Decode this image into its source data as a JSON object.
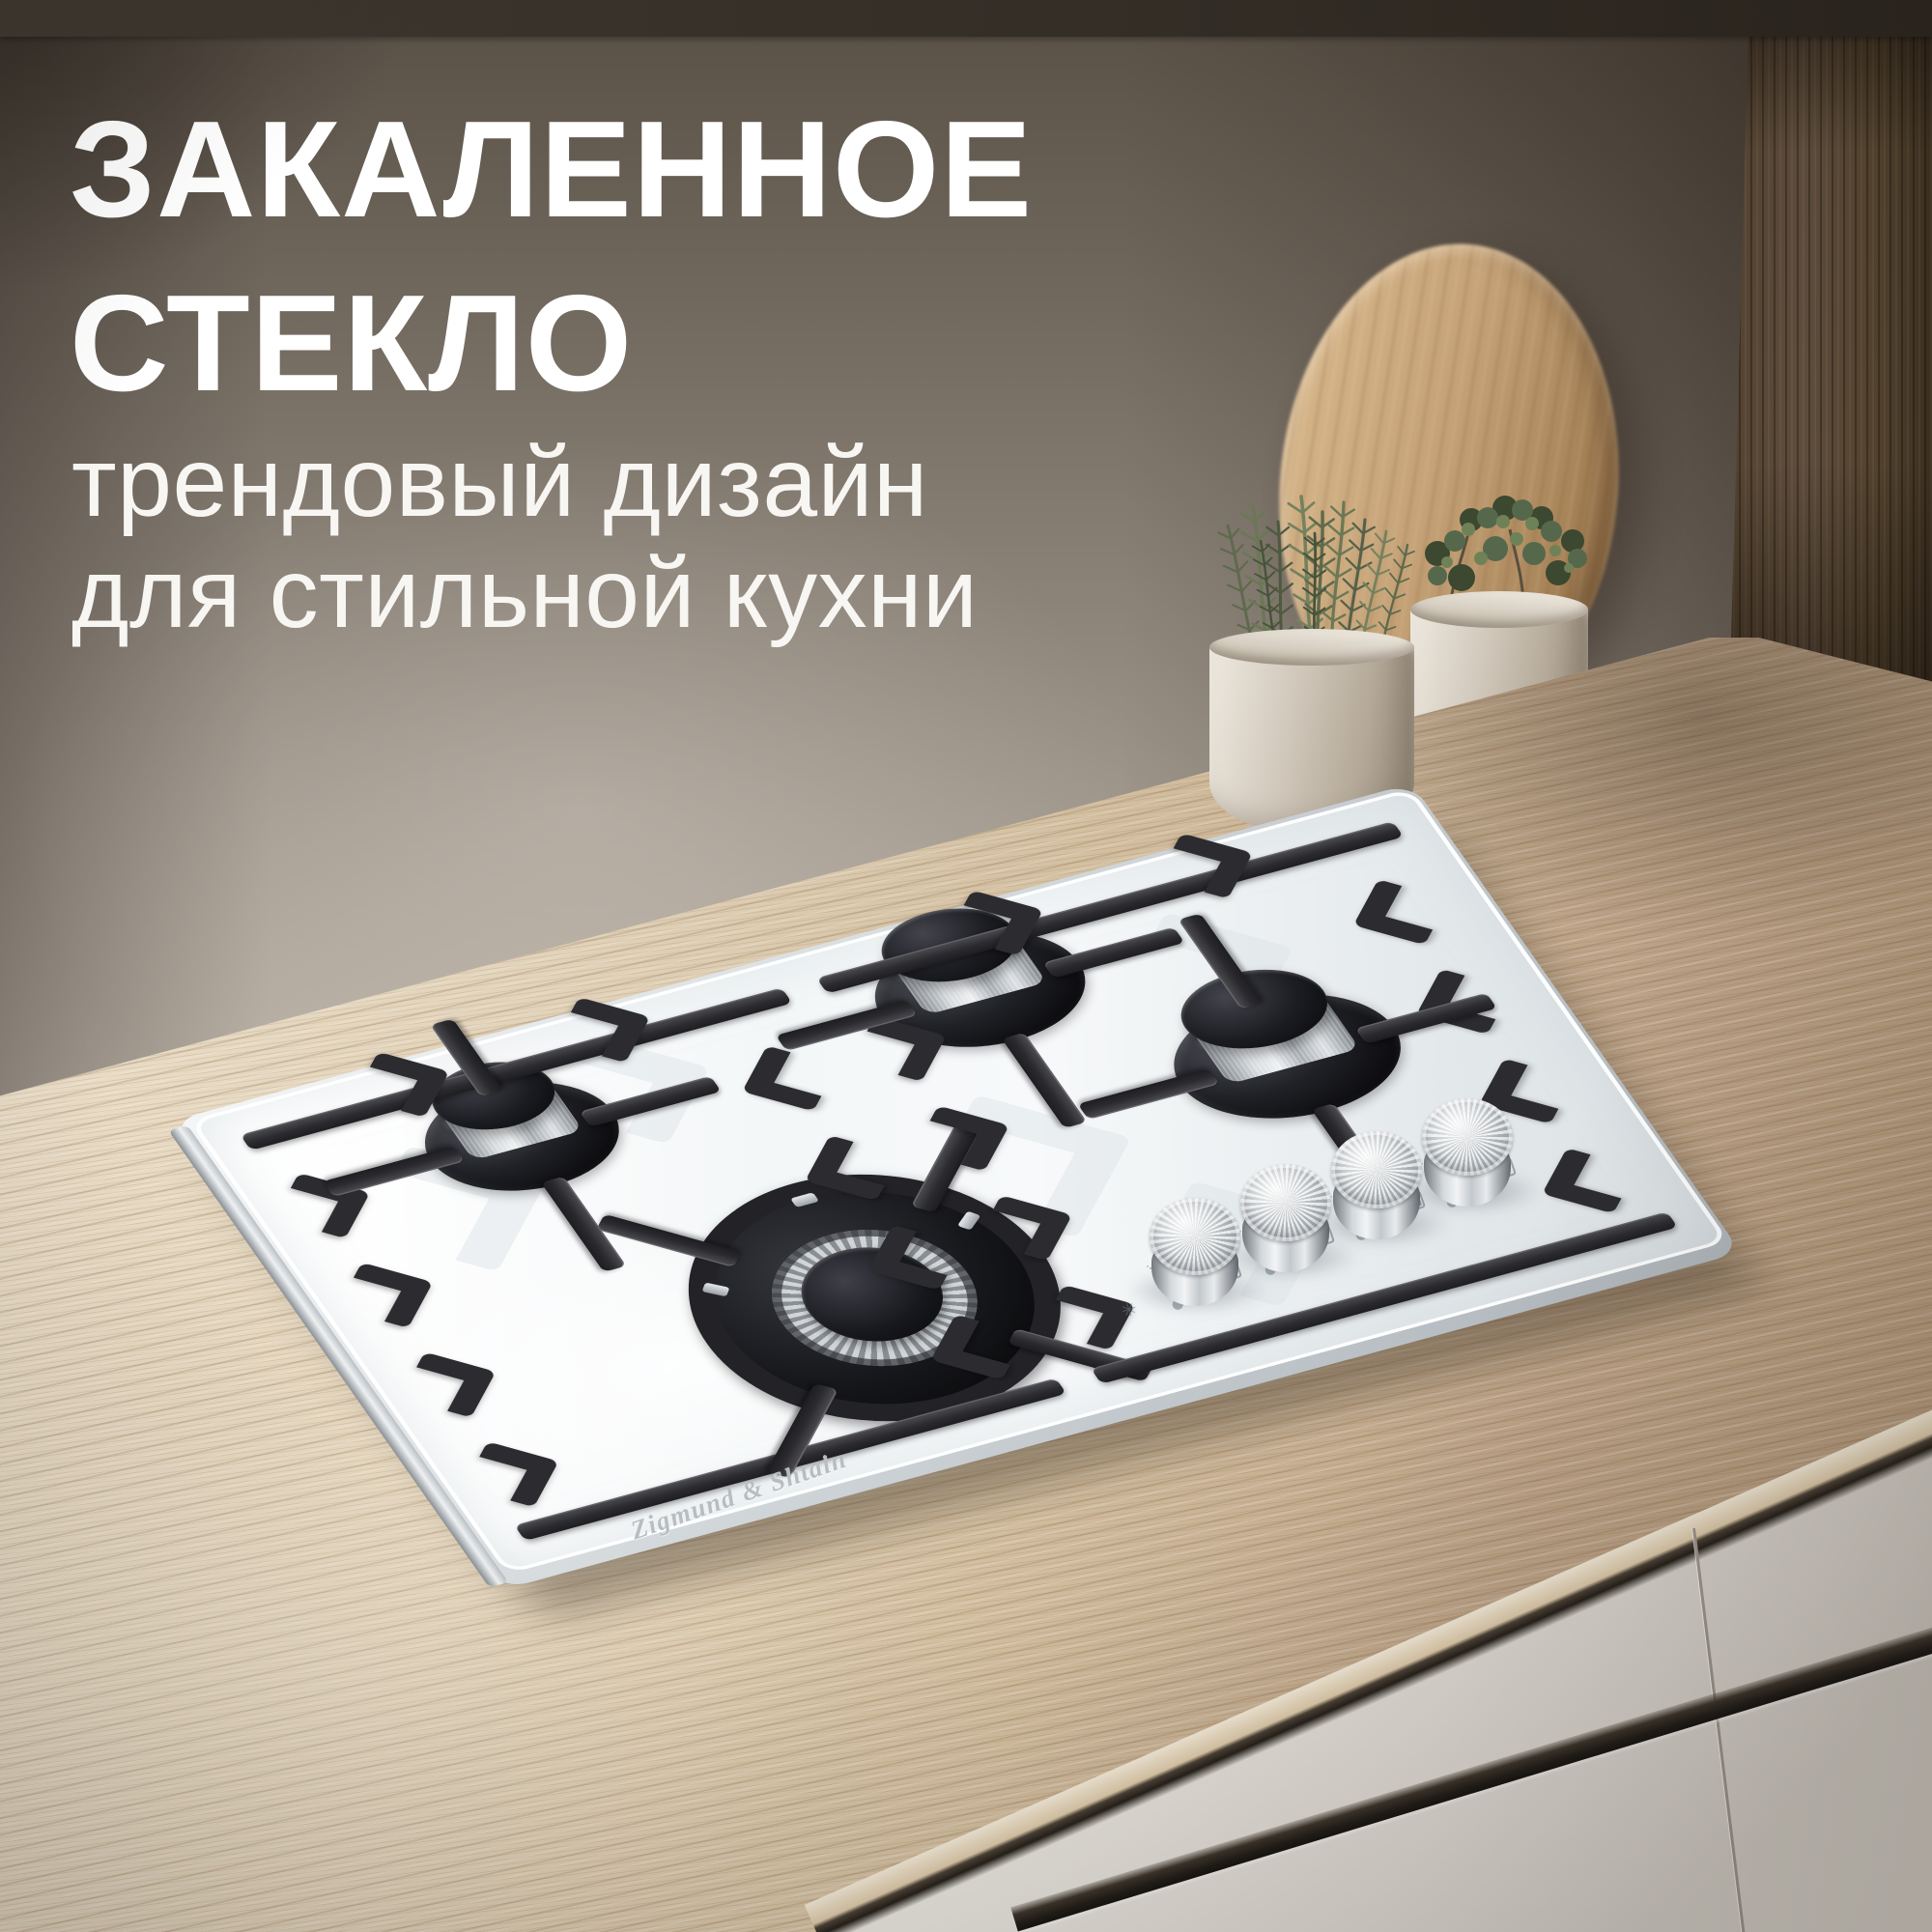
{
  "headline": {
    "line1": "ЗАКАЛЕННОЕ",
    "line2": "СТЕКЛО"
  },
  "subtitle": {
    "line1": "трендовый дизайн",
    "line2": "для стильной кухни"
  },
  "hob": {
    "brand_engraving": "Zigmund & Shtain",
    "burner_count": 4,
    "knob_count": 4,
    "control_icons": [
      "burner-position-icon",
      "flame-icon",
      "spark-icon"
    ]
  },
  "colors": {
    "headline_text": "#ffffff",
    "wall_dark": "#584f45",
    "wall_light": "#ece4d8",
    "counter_light": "#e2d3ba",
    "counter_dark": "#b49a7c",
    "glass_white": "#f7f9fa",
    "grate_black": "#2c2c30",
    "enamel_black": "#141417",
    "steel_light": "#eef0f2",
    "steel_dark": "#979da2",
    "cabinet_cream": "#ebe8e2",
    "panel_wood": "#63513f",
    "board_wood": "#c5a277",
    "pot_greige": "#d2c9bd",
    "plant_green": "#5a684a"
  }
}
